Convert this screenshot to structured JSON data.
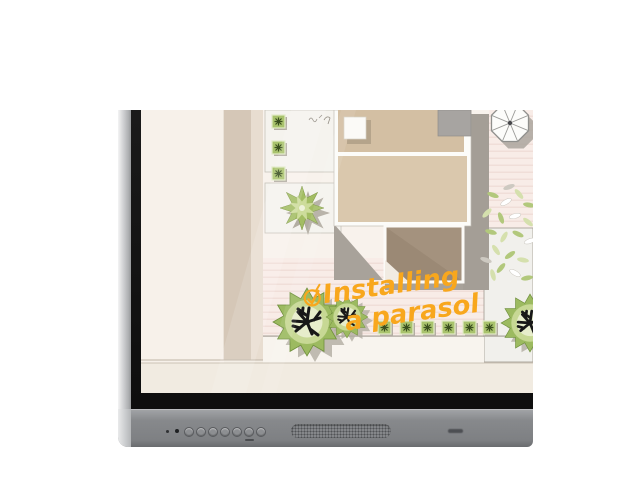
{
  "page": {
    "background": "#ffffff"
  },
  "device": {
    "name": "interactive-flat-panel",
    "bezel_color": "#85878a",
    "edge_color": "#c6c8ca",
    "screen_border_color": "#141414",
    "led_count": 2,
    "button_count": 7,
    "has_speaker_grille": true
  },
  "screen": {
    "paper_color": "#f8f2ec",
    "annotation": {
      "line1": "Installing",
      "line2": "a parasol",
      "color": "#f8a71d"
    },
    "palette": {
      "path_beige": "#d5c7b7",
      "room_beige": "#d3bfa3",
      "room_dark": "#a4927e",
      "decking_pink": "#f8ece7",
      "foliage_green": "#9cba60",
      "foliage_light": "#c7d894",
      "shadow_gray": "#a8a29a"
    },
    "plan_elements": [
      "house-floor-plan",
      "parasol-top-view",
      "star-plant",
      "box-hedge-row",
      "topiary-tree-large",
      "topiary-tree-medium",
      "topiary-tree-right",
      "leafy-shrub",
      "decking",
      "terrace-panel"
    ]
  }
}
